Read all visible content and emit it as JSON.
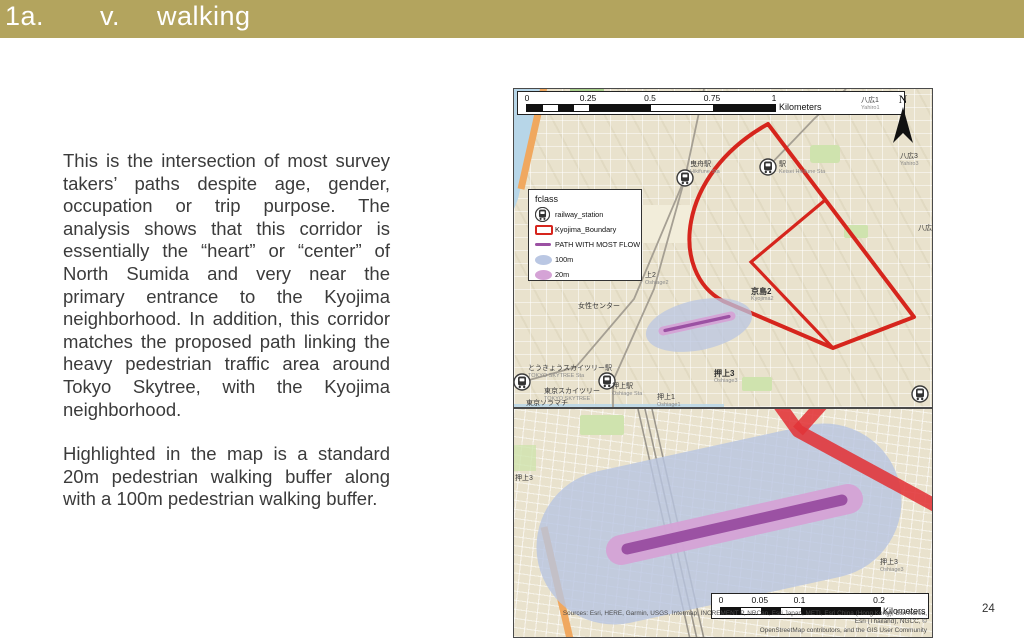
{
  "title_bar": {
    "number": "1a.",
    "item": "v.",
    "label": "walking",
    "bg_color": "#b3a45e"
  },
  "page_number": "24",
  "body_text": {
    "paragraph_1": "This is the intersection of most survey takers’ paths despite age, gender, occupation or trip purpose. The analysis shows that this corridor is essentially the “heart” or “center” of North Sumida and very near the primary entrance to the Kyojima neighborhood. In addition, this corridor matches the proposed path linking the heavy pedestrian traffic area around Tokyo Skytree, with the Kyojima neighborhood.",
    "paragraph_2": "Highlighted in the map is a standard 20m pedestrian walking buffer along with a 100m pedestrian walking buffer."
  },
  "legend": {
    "title": "fclass",
    "items": [
      {
        "label": "railway_station",
        "swatch": "railway-station-icon"
      },
      {
        "label": "Kyojima_Boundary",
        "swatch": "red-outline"
      },
      {
        "label": "PATH WITH MOST FLOW",
        "swatch": "purple-line"
      },
      {
        "label": "100m",
        "swatch": "blue-buffer"
      },
      {
        "label": "20m",
        "swatch": "pink-buffer"
      }
    ]
  },
  "map_top": {
    "north_label": "N",
    "scale_bar": {
      "ticks": [
        "0",
        "0.25",
        "0.5",
        "0.75",
        "1"
      ],
      "unit": "Kilometers"
    },
    "labels": [
      {
        "jp": "八広1",
        "en": "Yahiro1"
      },
      {
        "jp": "八広3",
        "en": "Yahiro3"
      },
      {
        "jp": "八広"
      },
      {
        "jp": "曳舟駅",
        "en": "Hikifune Sta"
      },
      {
        "jp": "駅",
        "en": "Keisei Hikifune Sta"
      },
      {
        "jp": "京島2",
        "en": "Kyojima2"
      },
      {
        "jp": "押上3",
        "en": "Oshiage3"
      },
      {
        "jp": "押上1",
        "en": "Oshiage1"
      },
      {
        "jp": "上2",
        "en": "Oshiage2"
      },
      {
        "jp": "女性センター"
      },
      {
        "jp": "とうきょうスカイツリー駅",
        "en": "TOKYO SKYTREE Sta"
      },
      {
        "jp": "押上駅",
        "en": "Oshiage Sta"
      },
      {
        "jp": "東京スカイツリー",
        "en": "TOKYO SKYTREE"
      },
      {
        "jp": "東京ソラマチ"
      }
    ]
  },
  "map_bottom": {
    "scale_bar": {
      "ticks": [
        "0",
        "0.05",
        "0.1",
        "0.2"
      ],
      "unit": "Kilometers"
    },
    "labels": [
      {
        "jp": "押上3",
        "en": "Oshiage3"
      },
      {
        "jp": "押上3"
      }
    ],
    "attribution": {
      "line_1": "Sources: Esri, HERE, Garmin, USGS, Intermap, INCREMENT P, NRCan, Esri Japan, METI, Esri China (Hong Kong), Esri Korea, Esri (Thailand), NGCC, ©",
      "line_2": "OpenStreetMap contributors, and the GIS User Community"
    }
  },
  "colors": {
    "accent_bar": "#b3a45e",
    "boundary_red": "#d6251d",
    "path_purple": "#9b51a3",
    "buffer_20m": "#d5a3d6",
    "buffer_100m": "#bac7e3",
    "road_red": "#e13338",
    "map_base": "#e9e2cd"
  }
}
